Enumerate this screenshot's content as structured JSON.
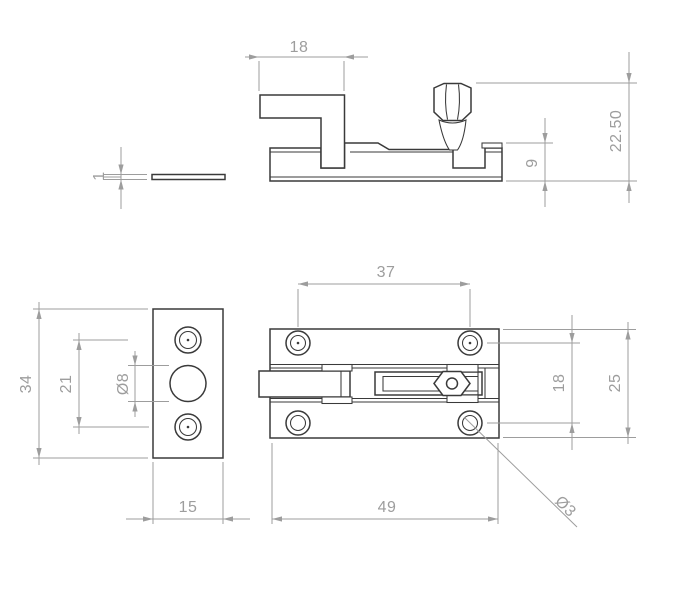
{
  "dimensions": {
    "side_view": {
      "bolt_length": "18",
      "overall_height": "22.50",
      "base_height": "9"
    },
    "plate_side_view": {
      "thickness": "1"
    },
    "keeper_plate_view": {
      "height": "34",
      "hole_spacing": "21",
      "center_hole_diameter": "Ø8",
      "width": "15"
    },
    "plan_view": {
      "screw_hole_span_length": "37",
      "screw_hole_span_width": "18",
      "body_width": "25",
      "body_length": "49",
      "screw_hole_diameter": "Ø3"
    }
  },
  "colors": {
    "geometry_line": "#3a3a3a",
    "dimension_line": "#9d9d9d",
    "background": "#ffffff"
  }
}
